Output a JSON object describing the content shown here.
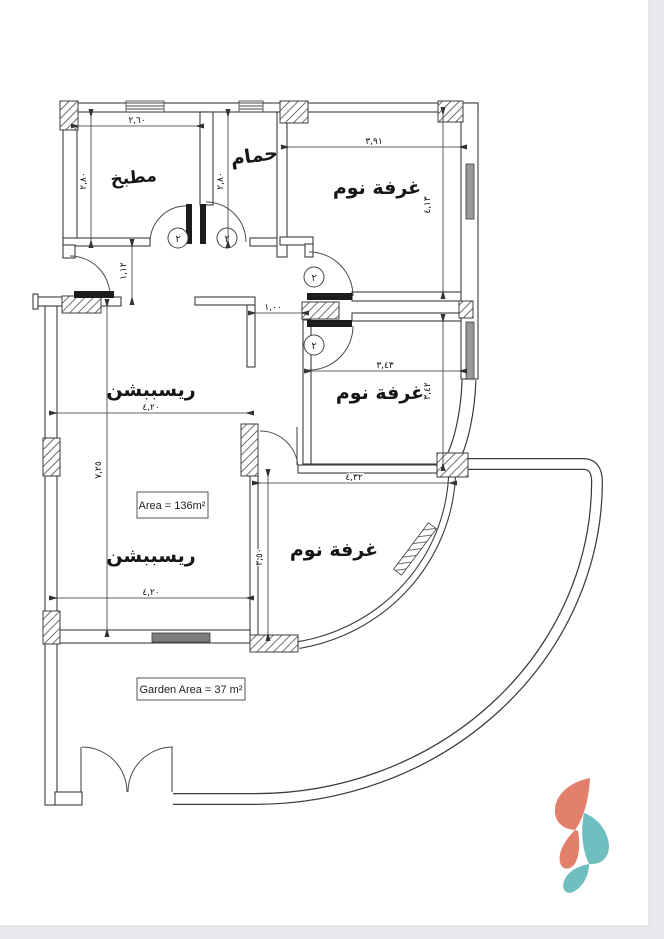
{
  "drawing": {
    "rooms": {
      "kitchen": "مطبخ",
      "bathroom": "حمام",
      "bedroom1": "غرفة نوم",
      "bedroom2": "غرفة نوم",
      "bedroom3": "غرفة نوم",
      "reception_upper": "ريسببشن",
      "reception_lower": "ريسببشن"
    },
    "dims": {
      "kitchen_width": "٢,٦٠",
      "kitchen_height": "٢,٨٠",
      "bathroom_height": "٢,٨٠",
      "entry_recess": "١,١٢",
      "bedroom1_width": "٣,٩١",
      "bedroom1_height": "٤,١٣",
      "hall_opening": "١,٠٠",
      "bedroom2_width": "٣,٤٣",
      "bedroom2_height": "٣,٤٢",
      "reception_width": "٤,٢٠",
      "reception_height": "٧,٢٥",
      "bedroom3_width": "٤,٣٢",
      "bedroom3_height": "٣,٥٠",
      "reception_width_lower": "٤,٢٠"
    },
    "labels": {
      "area": "Area = 136m²",
      "garden": "Garden Area = 37 m²"
    },
    "door_tag": "٢",
    "colors": {
      "logo_coral": "#E2806B",
      "logo_teal": "#6FBEC0",
      "wall": "#3c3c3c",
      "page_edge": "#e9e7ec"
    }
  }
}
